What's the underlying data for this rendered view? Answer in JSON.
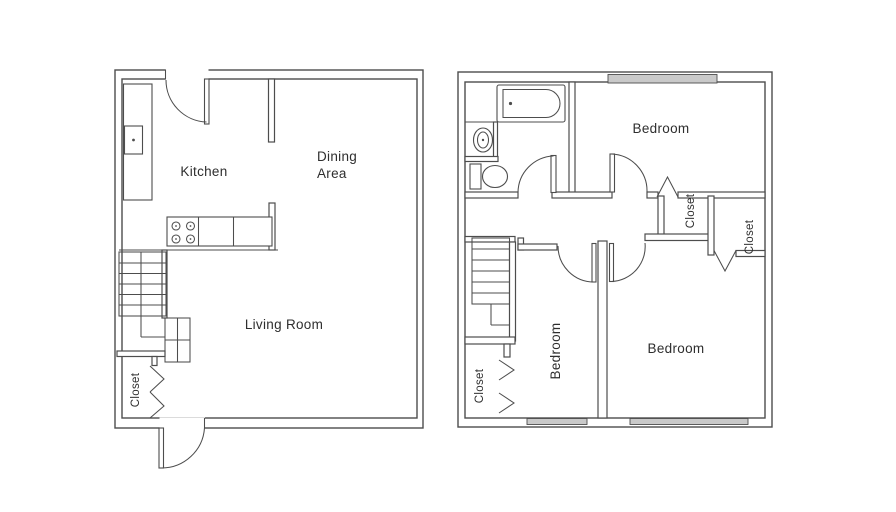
{
  "colors": {
    "line": "#4d4d4d",
    "text": "#2e2e2e",
    "window_fill": "#c9c9c9",
    "bg": "#ffffff"
  },
  "floor_plans": {
    "first_floor": {
      "rooms": {
        "kitchen": {
          "label": "Kitchen"
        },
        "dining_area": {
          "line1": "Dining",
          "line2": "Area"
        },
        "living_room": {
          "label": "Living Room"
        },
        "closet": {
          "label": "Closet"
        }
      }
    },
    "second_floor": {
      "rooms": {
        "bedroom_top": {
          "label": "Bedroom"
        },
        "bedroom_bottom_left": {
          "label": "Bedroom"
        },
        "bedroom_bottom_right": {
          "label": "Bedroom"
        },
        "closet_top_right": {
          "label": "Closet"
        },
        "closet_far_right": {
          "label": "Closet"
        },
        "closet_bottom_left": {
          "label": "Closet"
        }
      }
    }
  }
}
